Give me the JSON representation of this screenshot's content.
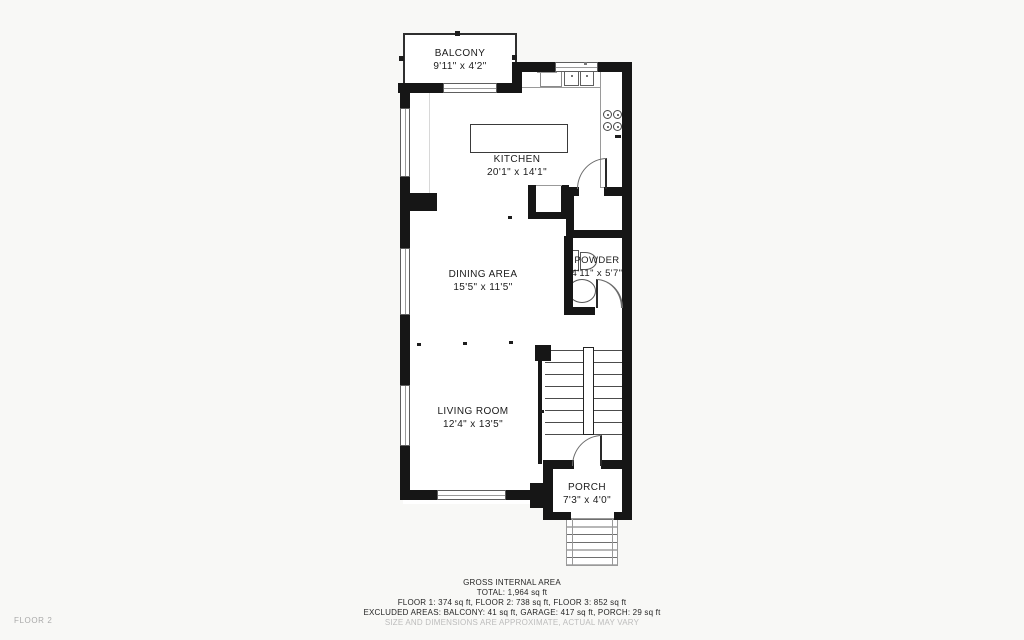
{
  "floor_label": "FLOOR 2",
  "rooms": {
    "balcony": {
      "name": "BALCONY",
      "dims": "9'11\" x 4'2\""
    },
    "kitchen": {
      "name": "KITCHEN",
      "dims": "20'1\" x 14'1\""
    },
    "dining": {
      "name": "DINING AREA",
      "dims": "15'5\" x 11'5\""
    },
    "powder": {
      "name": "POWDER",
      "dims": "4'11\" x 5'7\""
    },
    "living": {
      "name": "LIVING ROOM",
      "dims": "12'4\" x 13'5\""
    },
    "porch": {
      "name": "PORCH",
      "dims": "7'3\" x 4'0\""
    }
  },
  "appliances": {
    "washer_label": "WM"
  },
  "footer": {
    "line1": "GROSS INTERNAL AREA",
    "line2": "TOTAL: 1,964 sq ft",
    "line3": "FLOOR 1: 374 sq ft, FLOOR 2: 738 sq ft, FLOOR 3: 852 sq ft",
    "line4": "EXCLUDED AREAS: BALCONY: 41 sq ft, GARAGE: 417 sq ft, PORCH: 29 sq ft",
    "line5": "SIZE AND DIMENSIONS ARE APPROXIMATE, ACTUAL MAY VARY"
  },
  "colors": {
    "wall": "#161616",
    "background": "#f8f8f6",
    "muted_text": "#bcbcbc",
    "label_text": "#1b1b1b"
  }
}
